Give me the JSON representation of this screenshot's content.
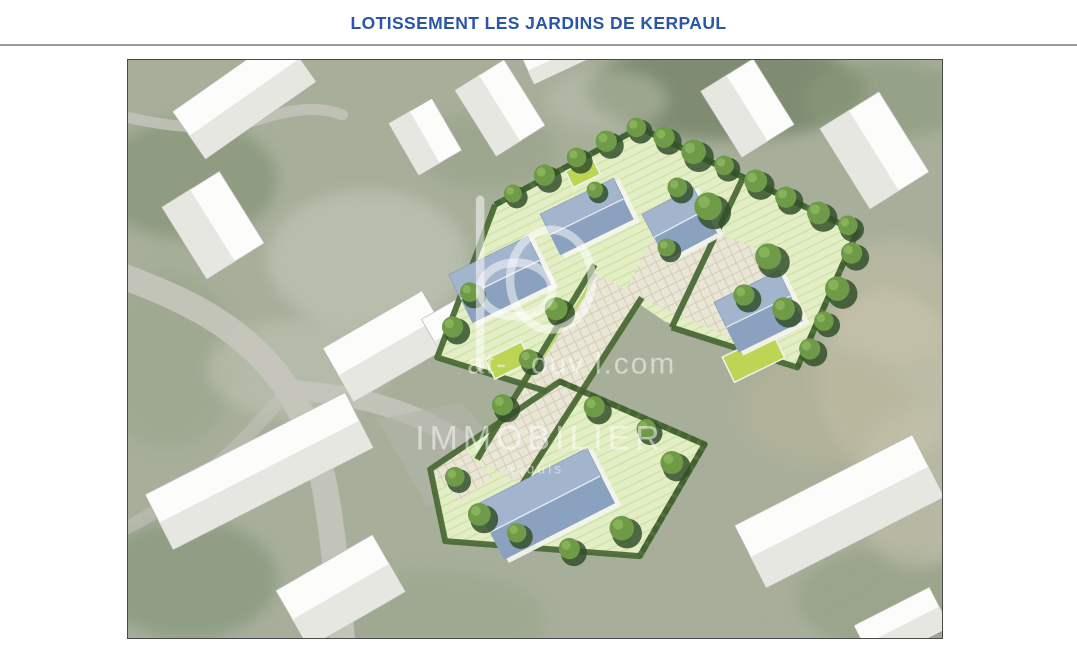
{
  "page": {
    "title": "LOTISSEMENT LES JARDINS DE KERPAUL"
  },
  "header": {
    "title_color": "#2B56A7",
    "separator_color": "#9b9b9b"
  },
  "aerial": {
    "border_color": "#4a4a4a",
    "watermark": {
      "logo_text": "bo",
      "domain_fragments": [
        "at-",
        "ouv",
        "l.com"
      ],
      "brand": "IMMOBILIER",
      "tagline": "acquis"
    },
    "palette": {
      "ground": "#a7af9b",
      "road": "#c6c6bd",
      "lawn": "#e3eec6",
      "hedge": "#4b6a36",
      "roof_blue": "#a2b5cc",
      "annex_green": "#bdd554",
      "building_white": "#fcfcfa",
      "pavement": "#eae6d5"
    }
  }
}
